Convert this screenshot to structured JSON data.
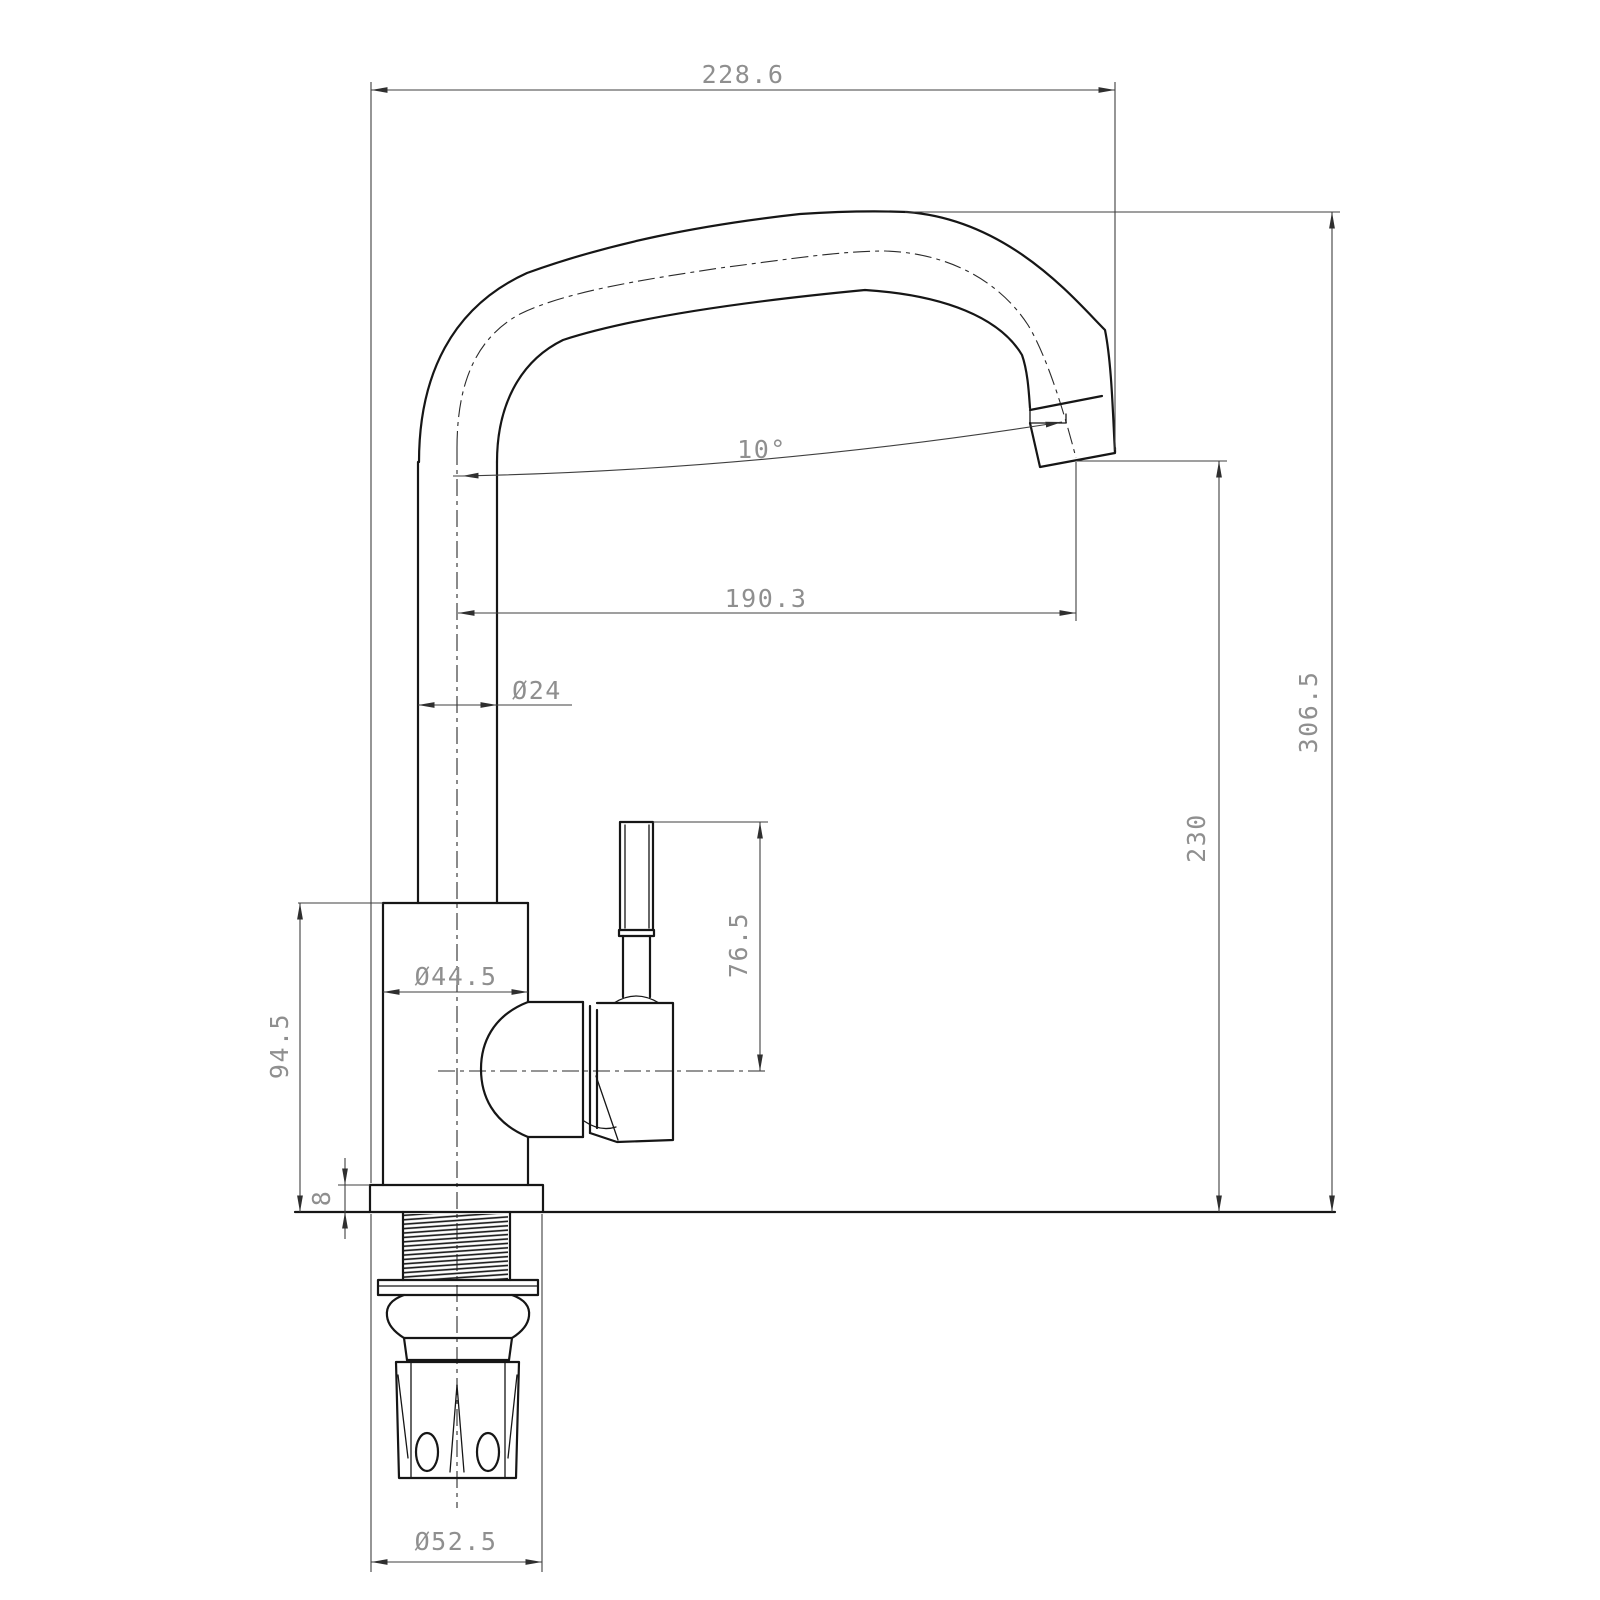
{
  "drawing": {
    "type": "technical-dimension-drawing",
    "subject": "kitchen-mixer-tap-side-view",
    "units_shown": "mm",
    "colors": {
      "background": "#ffffff",
      "object_line": "#161616",
      "dimension_line": "#3f3f3f",
      "dimension_text": "#8f8f8f"
    },
    "dims": {
      "overall_width": "228.6",
      "spout_reach": "190.3",
      "spout_angle": "10°",
      "spout_tube_diameter": "Ø24",
      "body_diameter": "Ø44.5",
      "body_height": "94.5",
      "base_plate_thickness": "8",
      "handle_height": "76.5",
      "overall_height": "306.5",
      "outlet_height": "230",
      "base_diameter": "Ø52.5"
    }
  }
}
